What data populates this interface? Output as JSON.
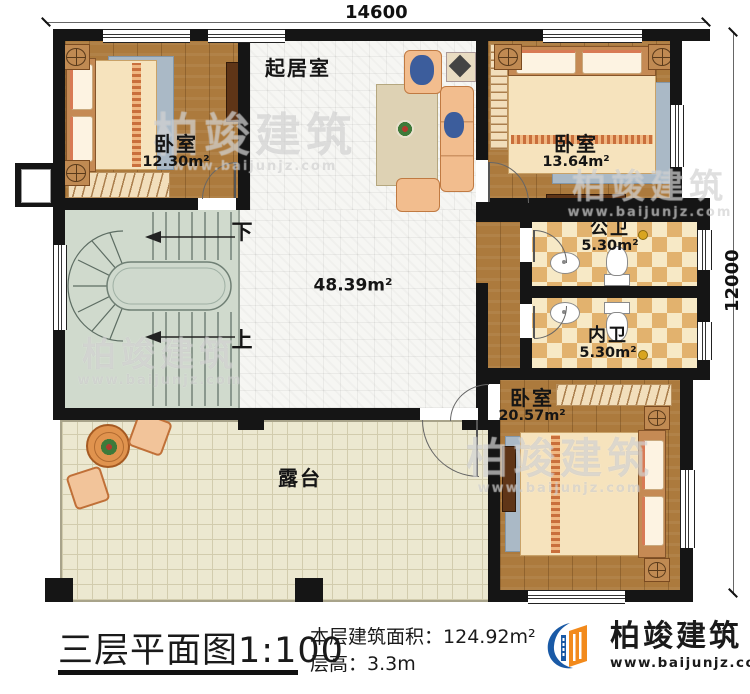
{
  "dimensions": {
    "top": "14600",
    "right": "12000"
  },
  "rooms": {
    "living": {
      "name": "起居室"
    },
    "bedroom_tl": {
      "name": "卧室",
      "area": "12.30m²"
    },
    "bedroom_tr": {
      "name": "卧室",
      "area": "13.64m²"
    },
    "public_bath": {
      "name": "公卫",
      "area": "5.30m²"
    },
    "private_bath": {
      "name": "内卫",
      "area": "5.30m²"
    },
    "bedroom_br": {
      "name": "卧室",
      "area": "20.57m²"
    },
    "hall": {
      "area": "48.39m²"
    },
    "terrace": {
      "name": "露台"
    },
    "stairs": {
      "down": "下",
      "up": "上"
    }
  },
  "footer": {
    "title": "三层平面图",
    "scale": "1:100",
    "floor_area_label": "本层建筑面积：",
    "floor_area_value": "124.92m²",
    "floor_height_label": "层高：",
    "floor_height_value": "3.3m",
    "brand_name": "柏竣建筑",
    "brand_url": "www.baijunjz.com"
  },
  "watermark": {
    "text": "柏竣建筑",
    "url": "www.baijunjz.com"
  },
  "icons": {
    "logo": "building-swoosh-logo",
    "stairs": "spiral-staircase",
    "bed": "double-bed",
    "toilet": "toilet",
    "sink": "washbasin",
    "sofa": "sofa-set",
    "table": "round-table",
    "door": "door-swing-arc",
    "window": "window-glazing-lines"
  },
  "colors": {
    "wall": "#151515",
    "wood_floor": "#ac7a3d",
    "white_tile": "#f6f6f3",
    "bath_checker_light": "#f7e9c6",
    "bath_checker_dark": "#e2b26e",
    "terrace_floor": "#ece8d0",
    "stair_floor": "#d0dacd",
    "brand_blue": "#1a5aa6",
    "brand_orange": "#f28a1c"
  }
}
